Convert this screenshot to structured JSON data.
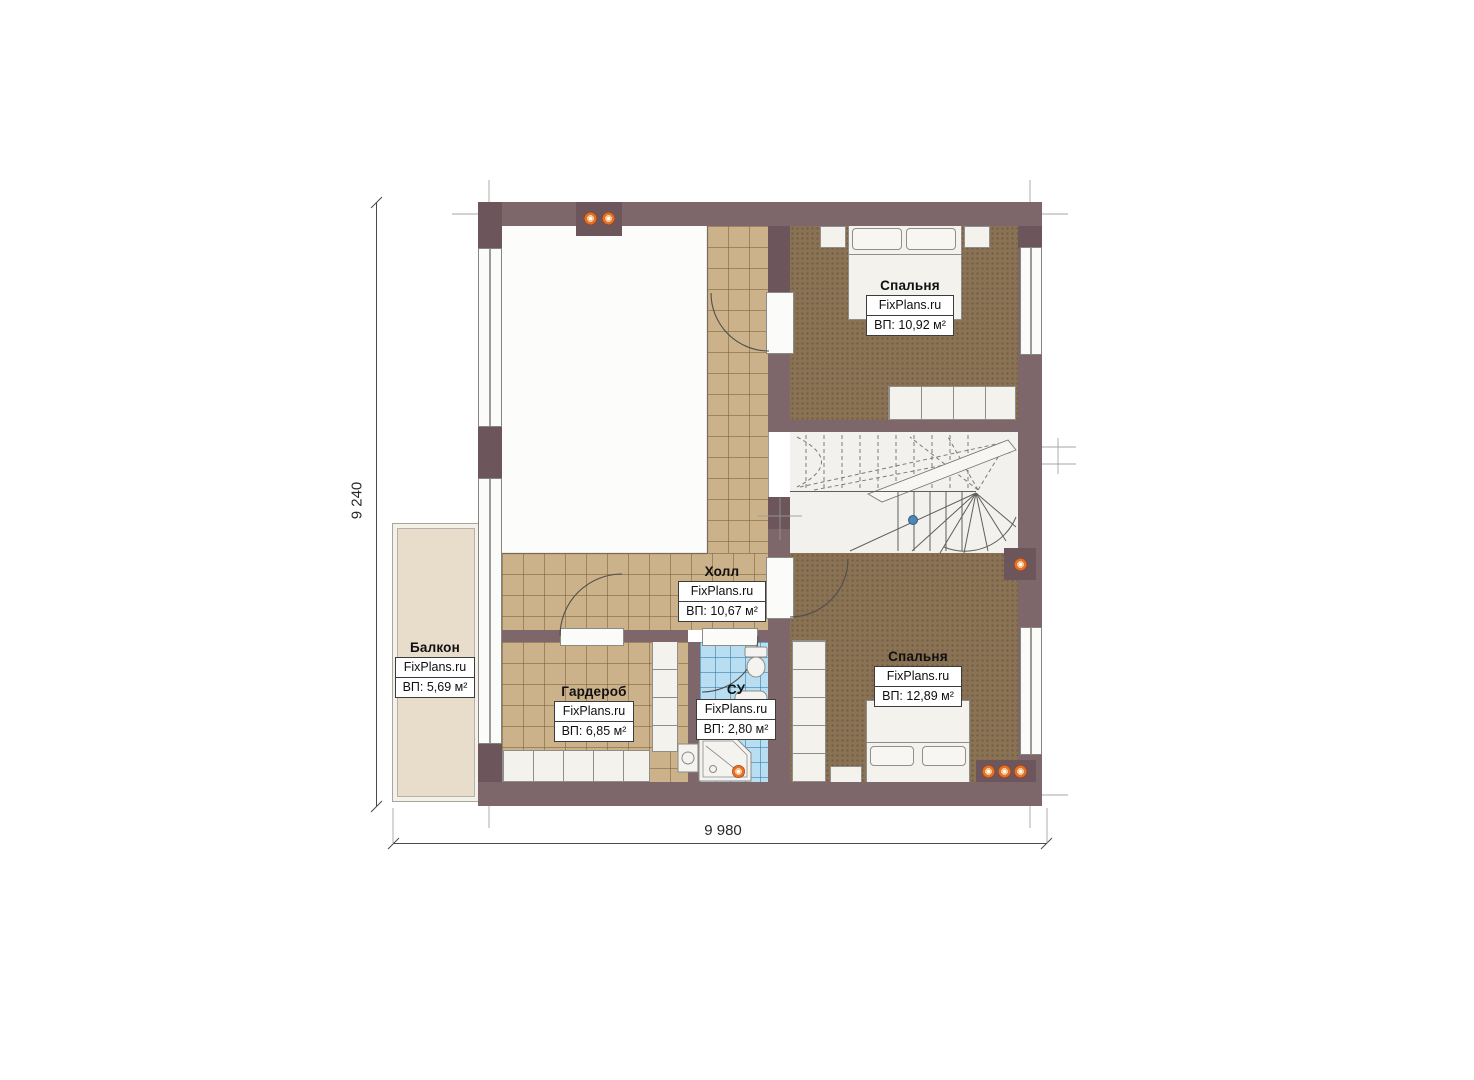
{
  "watermark": "FixPlans.ru",
  "dimensions": {
    "left": "9 240",
    "bottom": "9 980"
  },
  "rooms": {
    "bedroom_top": {
      "name": "Спальня",
      "area": "ВП: 10,92 м²"
    },
    "hall": {
      "name": "Холл",
      "area": "ВП: 10,67 м²"
    },
    "bedroom_bottom": {
      "name": "Спальня",
      "area": "ВП: 12,89 м²"
    },
    "wardrobe": {
      "name": "Гардероб",
      "area": "ВП: 6,85 м²"
    },
    "bathroom": {
      "name": "СУ",
      "area": "ВП: 2,80 м²"
    },
    "balcony": {
      "name": "Балкон",
      "area": "ВП: 5,69 м²"
    }
  },
  "icons": {
    "ceiling_light": "orange ceiling-light dot",
    "stair_marker": "blue stair direction marker"
  },
  "colors": {
    "wall": "#7d676b",
    "wall_pier": "#6c565b",
    "tile_floor": "#cbb28a",
    "wood_floor": "#8a7254",
    "bath_tile": "#b9def2",
    "balcony_floor": "#e8dcca",
    "light_accent": "#e4702a",
    "stair_marker": "#4f86b5"
  }
}
